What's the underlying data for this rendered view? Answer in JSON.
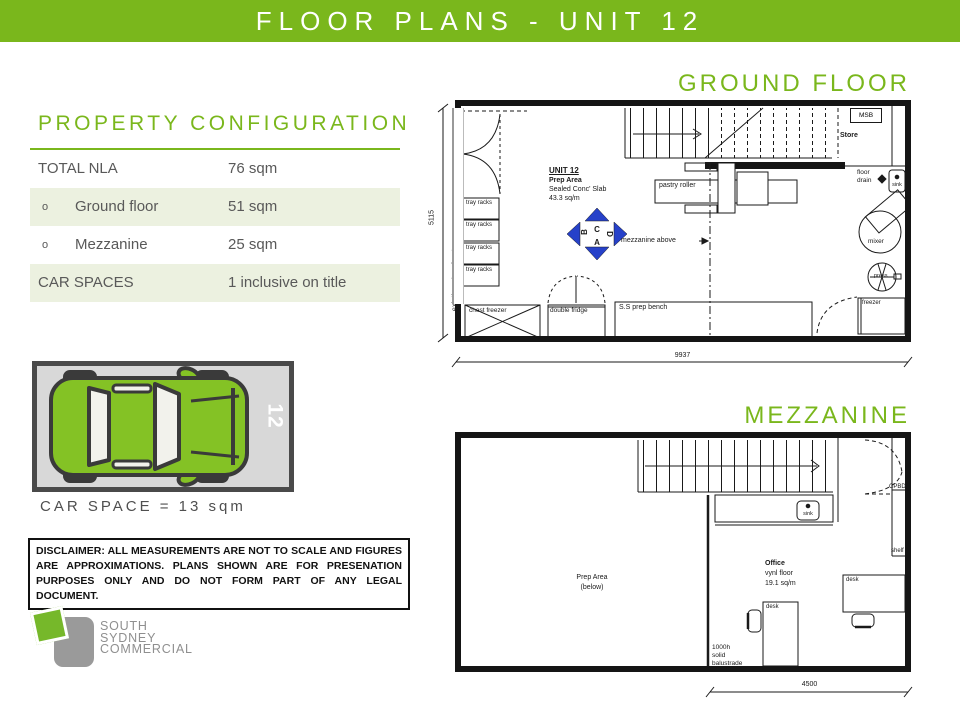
{
  "header": {
    "title": "FLOOR PLANS - UNIT 12"
  },
  "property": {
    "heading": "PROPERTY CONFIGURATION",
    "rows": [
      {
        "bullet": "",
        "label": "TOTAL NLA",
        "value": "76 sqm"
      },
      {
        "bullet": "o",
        "label": "Ground floor",
        "value": "51 sqm"
      },
      {
        "bullet": "o",
        "label": "Mezzanine",
        "value": "25 sqm"
      },
      {
        "bullet": "",
        "label": "CAR SPACES",
        "value": "1 inclusive on title"
      }
    ]
  },
  "car_space": {
    "number": "12",
    "caption": "CAR SPACE = 13 sqm"
  },
  "disclaimer": {
    "text": "DISCLAIMER: ALL MEASUREMENTS ARE NOT TO SCALE AND FIGURES ARE APPROXIMATIONS. PLANS SHOWN ARE FOR PRESENATION PURPOSES ONLY AND DO NOT FORM PART OF ANY LEGAL DOCUMENT."
  },
  "logo": {
    "line1": "SOUTH",
    "line2": "SYDNEY",
    "line3": "COMMERCIAL"
  },
  "ground_floor": {
    "heading": "GROUND FLOOR",
    "unit": {
      "name": "UNIT 12",
      "area_type": "Prep Area",
      "slab": "Sealed Conc' Slab",
      "area": "43.3 sq/m"
    },
    "labels": {
      "msb": "MSB",
      "store": "Store",
      "floor_drain_1": "floor",
      "floor_drain_2": "drain",
      "sink": "sink",
      "mixer": "mixer",
      "press": "press",
      "freezer": "freezer",
      "tray_racks": "tray racks",
      "chest_freezer": "chest freezer",
      "double_fridge": "double fridge",
      "prep_bench": "S.S prep bench",
      "pastry_roller": "pastry roller",
      "mezzanine_above": "mezzanine above",
      "existing_shop_front": "existing shop front"
    },
    "compass": {
      "top": "C",
      "left": "B",
      "right": "D",
      "bottom": "A"
    },
    "dimensions": {
      "width": "9937",
      "height": "5115"
    }
  },
  "mezzanine": {
    "heading": "MEZZANINE",
    "labels": {
      "cpbd": "CPBD",
      "shelf": "shelf",
      "sink": "sink",
      "prep_area_1": "Prep Area",
      "prep_area_2": "(below)",
      "office_1": "Office",
      "office_2": "vynl floor",
      "office_3": "19.1 sq/m",
      "desk": "desk",
      "balustrade_1": "1000h",
      "balustrade_2": "solid",
      "balustrade_3": "balustrade"
    },
    "dimensions": {
      "width": "4500"
    }
  },
  "colors": {
    "brand_green": "#7ab71c",
    "row_green": "#ecf1e0",
    "compass_blue": "#2641c9",
    "car_green": "#84c225"
  }
}
